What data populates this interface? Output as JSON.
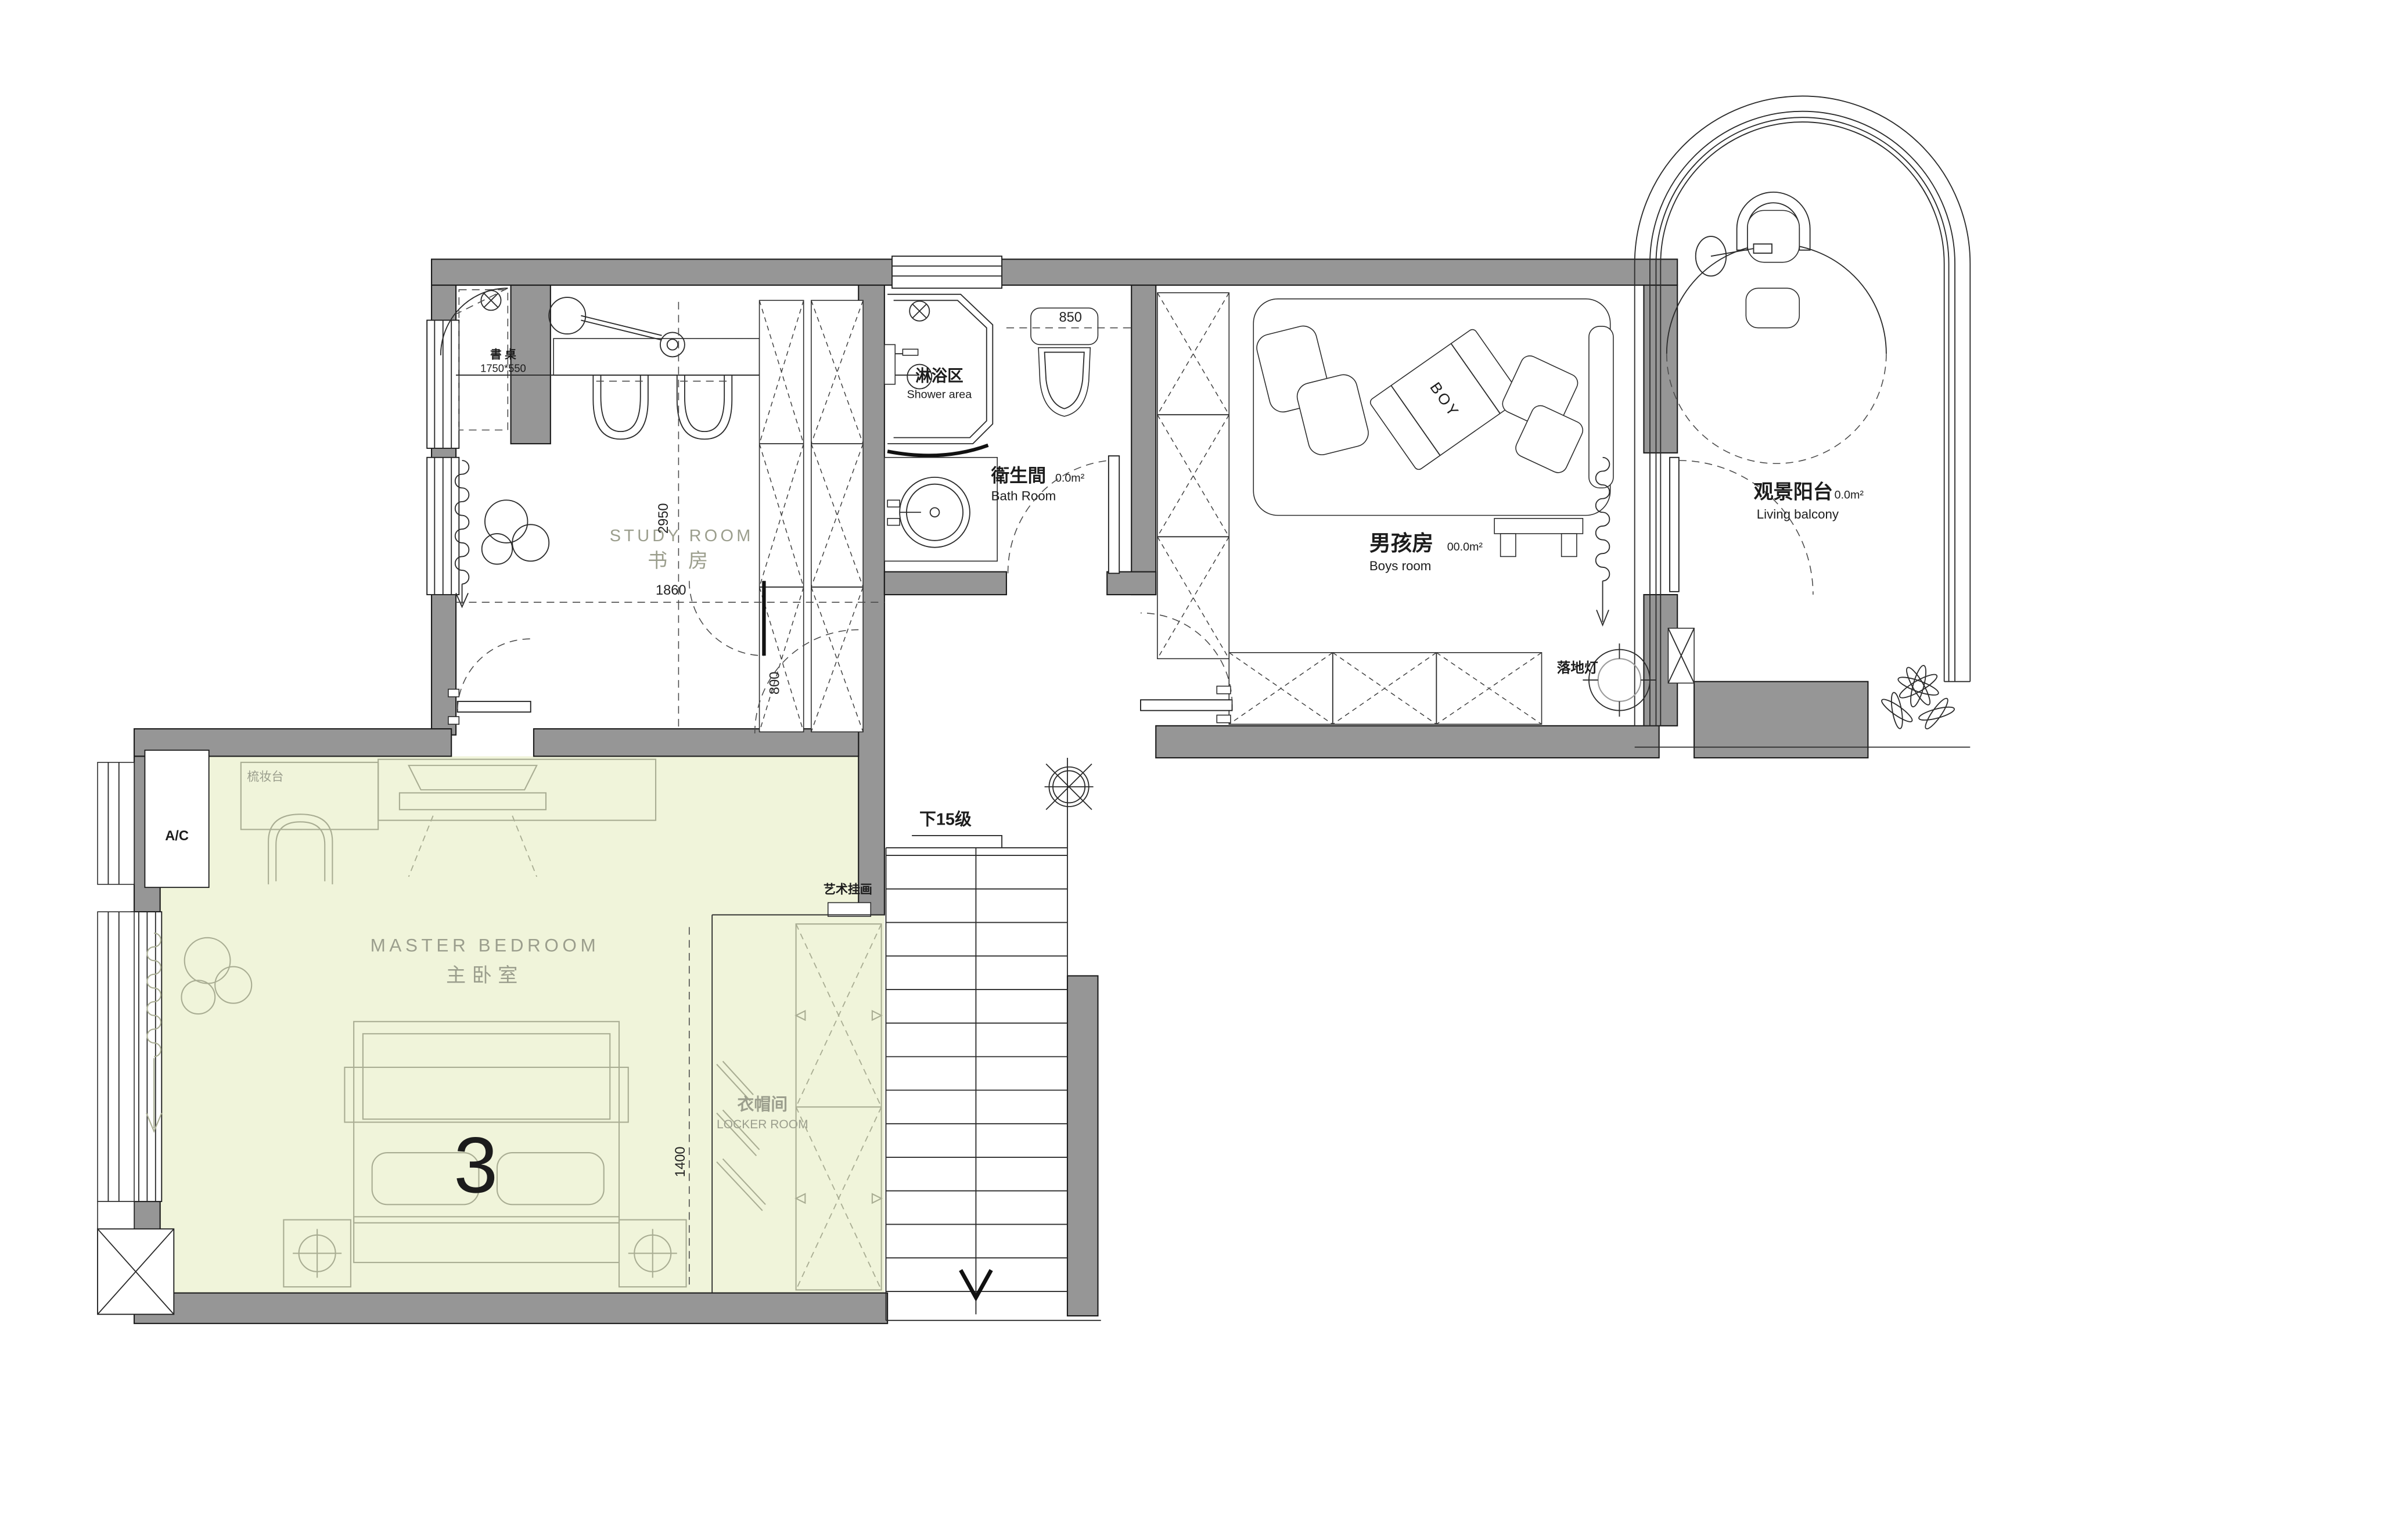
{
  "plan": {
    "study": {
      "name_en": "STUDY ROOM",
      "name_cn": "书  房",
      "desk_label": "書 桌",
      "desk_size": "1750*550"
    },
    "shower": {
      "name_cn": "淋浴区",
      "name_en": "Shower area"
    },
    "bath": {
      "name_cn": "衛生間",
      "area": "0.0m²",
      "name_en": "Bath Room"
    },
    "boys": {
      "name_cn": "男孩房",
      "area": "00.0m²",
      "name_en": "Boys room",
      "blanket": "BOY",
      "floor_lamp": "落地灯"
    },
    "balcony": {
      "name_cn": "观景阳台",
      "area": "0.0m²",
      "name_en": "Living balcony"
    },
    "master": {
      "name_en": "MASTER BEDROOM",
      "name_cn": "主卧室",
      "number": "3",
      "dresser": "梳妆台",
      "ac": "A/C"
    },
    "locker": {
      "name_cn": "衣帽间",
      "name_en": "LOCKER ROOM"
    },
    "stairs": {
      "note": "下15级"
    },
    "art_label": "艺术挂画"
  },
  "dimensions": {
    "study_depth": "2950",
    "study_width": "1860",
    "toilet_width": "850",
    "door_opening": "800",
    "locker_width": "1400"
  },
  "colors": {
    "wall": "#969696",
    "highlight": "#f0f4da",
    "furn": "#a9ad93",
    "text-gray": "#9b9e8d"
  }
}
